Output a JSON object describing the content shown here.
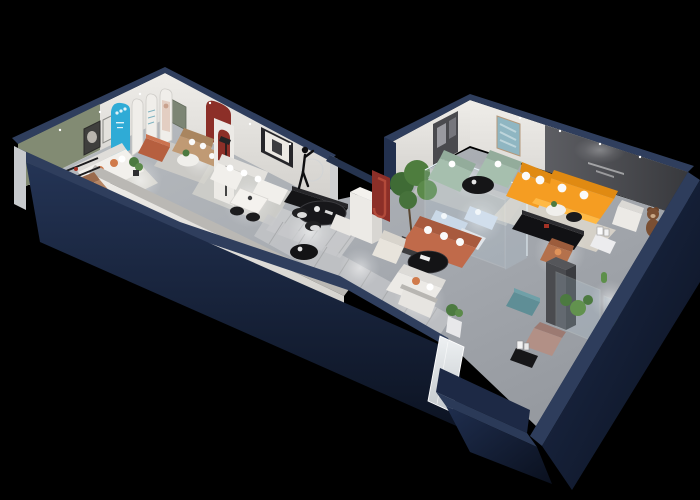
{
  "meta": {
    "title": "3D isometric showroom floor plan",
    "description": "Cutaway 3D dollhouse render of a furniture showroom apartment with two wings, dark navy outer walls, gray floors and staged furniture vignettes on a black background.",
    "canvas": {
      "width": 700,
      "height": 500
    },
    "background": "#000000"
  },
  "palette": {
    "outer_wall_face": "#1a2440",
    "outer_wall_dark": "#0c1220",
    "wall_top_cap": "#2f3e5d",
    "floor_light": "#b6babe",
    "floor_dark": "#94989e",
    "rug_cream": "#ded8cc",
    "rug_gray": "#c5c7c9",
    "white_wall": "#e9e7e3",
    "greige_wall": "#dddbd6",
    "green_accent_wall": "#828b73",
    "dark_feature_wall": "#515256",
    "cyan_arch": "#2fabd6",
    "red_arch": "#8c2f28",
    "orange_sofa": "#f59d22",
    "terracotta_sofa": "#c06a4a",
    "sage_sofa": "#a6bfae",
    "pale_blue_sofa": "#ccd9e8",
    "teal_ottoman": "#5f8e96",
    "tan_leather": "#b58563",
    "mauve_lounge": "#b29086",
    "bear_brown": "#7a4f33",
    "plant_green": "#4e7d3e",
    "black_furniture": "#141416",
    "glass": "#bcd4e4"
  },
  "scene": {
    "wings": [
      {
        "name": "left-wing",
        "rooms": [
          {
            "name": "green-accent-lounge",
            "wall_color": "#828b73",
            "furniture": [
              "white-sofa-orange-cushions",
              "black-round-side-table",
              "wall-art-frames",
              "area-rug",
              "potted-plant"
            ]
          },
          {
            "name": "entry-gallery",
            "features": [
              "cyan-arched-signboard",
              "white-arch-display-panels",
              "figure-poster",
              "green-door",
              "red-arch-niche"
            ],
            "furniture": [
              "terracotta-ottoman",
              "tan-loveseat",
              "round-white-table",
              "red-arch-lamp-column"
            ]
          },
          {
            "name": "main-living-display",
            "furniture": [
              "white-u-sectional",
              "white-dining-table",
              "black-dining-chairs",
              "framed-wall-art",
              "ring-floor-lamp",
              "mannequin-sculpture",
              "black-oval-dining-table",
              "curved-white-bench",
              "striped-dining-rug",
              "black-occasional-table"
            ]
          },
          {
            "name": "front-media-room",
            "furniture": [
              "tan-daybed",
              "wall-shelf-rails",
              "black-media-console",
              "white-oval-table",
              "white-daybed"
            ]
          }
        ]
      },
      {
        "name": "right-wing",
        "rooms": [
          {
            "name": "sage-lounge",
            "furniture": [
              "sage-green-sofa-set",
              "black-oval-coffee-table",
              "blue-abstract-art",
              "dark-frame-panel"
            ]
          },
          {
            "name": "orange-lounge",
            "wall_color": "#515256",
            "features": [
              "dark-feature-wall-with-tiny-slogan",
              "wall-washer-light"
            ],
            "furniture": [
              "orange-l-shaped-sectional",
              "white-throw-pillows",
              "black-media-bench",
              "white-armchair",
              "teddy-bear-figure",
              "round-side-table",
              "black-tray-table",
              "cream-rug"
            ]
          },
          {
            "name": "rear-display",
            "furniture": [
              "teal-ottoman",
              "gray-column",
              "glass-plant-cabinets",
              "cactus",
              "mauve-lounge-chair",
              "black-side-table",
              "rust-armchair"
            ]
          }
        ]
      },
      {
        "name": "connecting-gallery",
        "features": [
          "red-j-arch-banner",
          "glass-display-case",
          "white-pedestal-column",
          "mirror-panel",
          "white-partition"
        ],
        "furniture": [
          "terracotta-sofa",
          "cream-armchair",
          "black-oval-coffee-table",
          "potted-tree",
          "white-corner-sofa",
          "plant-pedestal",
          "striped-runner-rug",
          "pale-blue-display-sofa"
        ]
      }
    ]
  }
}
